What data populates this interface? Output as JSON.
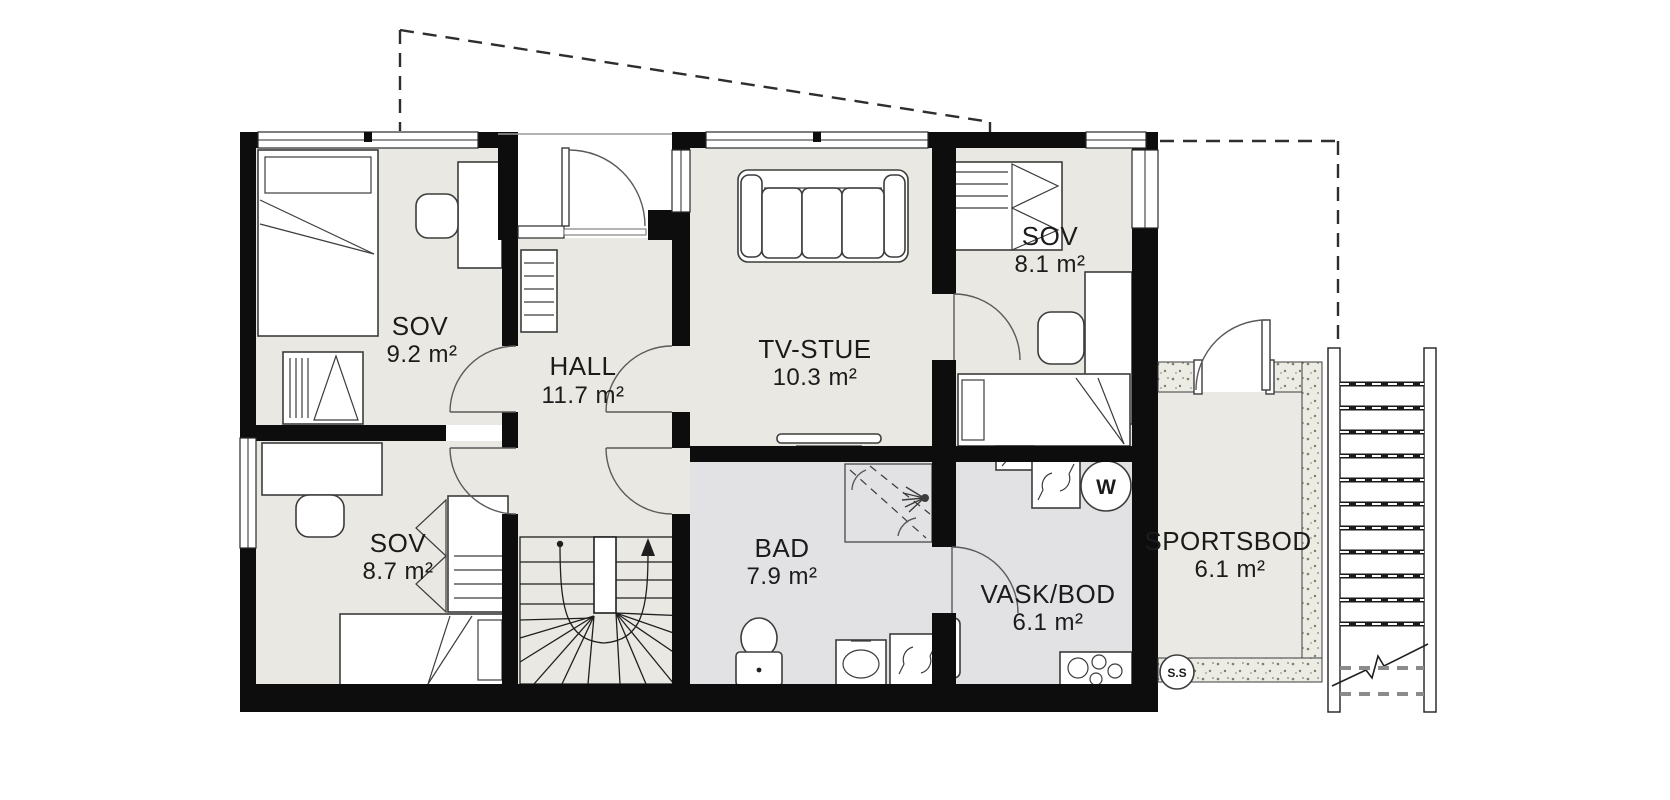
{
  "plan": {
    "title": "floor-plan",
    "rooms": [
      {
        "id": "sov-nw",
        "name": "SOV",
        "area": "9.2 m²"
      },
      {
        "id": "hall",
        "name": "HALL",
        "area": "11.7 m²"
      },
      {
        "id": "tv-stue",
        "name": "TV-STUE",
        "area": "10.3 m²"
      },
      {
        "id": "sov-ne",
        "name": "SOV",
        "area": "8.1 m²"
      },
      {
        "id": "sov-sw",
        "name": "SOV",
        "area": "8.7 m²"
      },
      {
        "id": "bad",
        "name": "BAD",
        "area": "7.9 m²"
      },
      {
        "id": "vask-bod",
        "name": "VASK/BOD",
        "area": "6.1 m²"
      },
      {
        "id": "sportsbod",
        "name": "SPORTSBOD",
        "area": "6.1 m²"
      }
    ],
    "markers": {
      "water_heater": "W",
      "floor_drain": "S.S"
    },
    "colors": {
      "wall": "#0d0d0d",
      "floor": "#e9e8e2",
      "wet_floor": "#e2e2e4",
      "storage_floor": "#eae9e3",
      "background": "#ffffff"
    }
  }
}
